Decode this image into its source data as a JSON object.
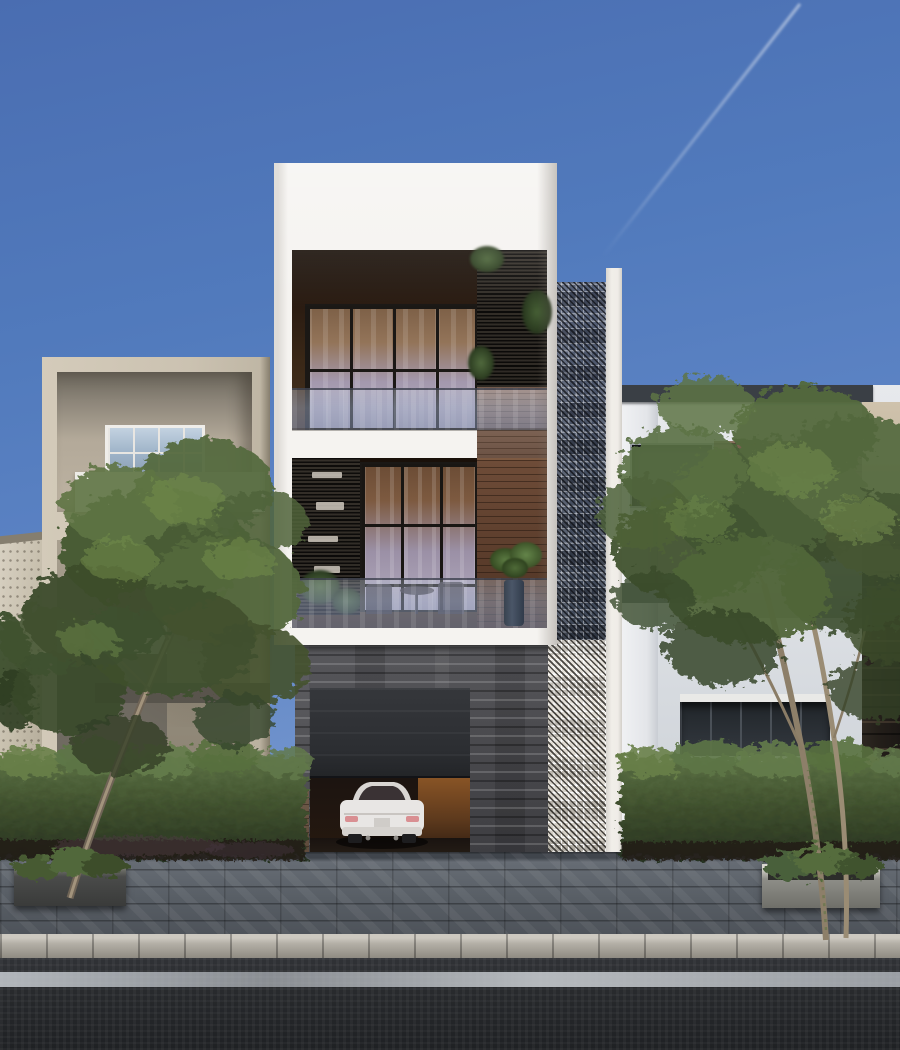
{
  "scene": {
    "type": "architectural-exterior-render",
    "description": "Daytime photorealistic render of a narrow modern three-storey townhouse with a white box facade, full-width glass walls with black mullions, dark louver screens, wood accent panels and glass balustrades. A tall perforated breeze-block lattice column runs down the right edge of the facade. The ground floor is clad in rough dark stone with an open garage revealing the rear of a white sedan and a warm-lit interior wall. Beige concrete neighbour building on the left, white flat-roofed neighbour on the right, dark rock-clad structure at far right. Two slender green trees rise from planters, a low hedge lines the street, with a paver sidewalk, granite curb, white road line and dark asphalt in the foreground. Clear blue sky with a faint jet contrail.",
    "elements": {
      "sky": {
        "label": "clear blue sky",
        "contrail": "faint diagonal jet contrail, upper right"
      },
      "center_house": {
        "label": "white modern townhouse",
        "floors": [
          "upper glass floor with louver screen and hanging plants",
          "middle glass floor with shelf louver, patio furniture and potted plant behind glass balustrade",
          "stone garage level"
        ],
        "materials": [
          "white render",
          "black-framed glazing",
          "dark timber louvers",
          "wood panelling",
          "frosted glass balustrade",
          "rough dark stone"
        ]
      },
      "lattice_column": {
        "label": "perforated breeze-block screen column",
        "tones": [
          "dark blue-grey upper section",
          "white lower section"
        ]
      },
      "garage": {
        "label": "open garage",
        "door_state": "partially raised dark door",
        "contents": "white sedan seen from rear",
        "accent": "warm orange-lit side wall"
      },
      "left_building": {
        "label": "beige concrete neighbour house with recessed white-framed window and white parapet"
      },
      "right_building": {
        "label": "white flat-roof neighbour house with dark window, wood strip band and dark window strip"
      },
      "far_right_structure": {
        "label": "dark rock-clad wall"
      },
      "far_left_structure": {
        "label": "small light stone gable house"
      },
      "landscaping": {
        "left_tree": "slender multi-branch green tree in dark planter",
        "right_tree": "taller twin-trunk green tree in concrete planter",
        "hedge": "continuous low green hedge along street"
      },
      "street": {
        "sidewalk": "grey stone pavers",
        "curb": "light granite curb stones",
        "road": "dark asphalt",
        "marking": "single white edge line"
      }
    }
  },
  "palette": {
    "sky-top": "#4a6db1",
    "sky-mid": "#5c83c4",
    "sky-horizon": "#a9c2e2",
    "facade-white": "#f5f3f0",
    "interior-dark": "#2b1c12",
    "glass-warm": "#937459",
    "glass-cool": "#b7b0c3",
    "frame-dark": "#1b1815",
    "wood-light": "#7e6355",
    "wood-dark": "#5a3c2b",
    "louver-dark": "#1b1815",
    "beige-wall": "#b8af9d",
    "stone-gray": "#4a4a4e",
    "lattice-dark": "#475062",
    "lattice-light": "#e9e5de",
    "roof-dark": "#3a3f45",
    "right-wall": "#dfe2e6",
    "rock-dark": "#241f1a",
    "hedge-green": "#42532f",
    "tree-green": "#4c5f38",
    "pavement-gray": "#575d64",
    "curb-gray": "#b3afa6",
    "asphalt-dark": "#26282b",
    "road-line": "#c4c8cc",
    "car-white": "#e8e6e4",
    "garage-door": "#2c2e32",
    "garage-glow": "#8a5526"
  }
}
